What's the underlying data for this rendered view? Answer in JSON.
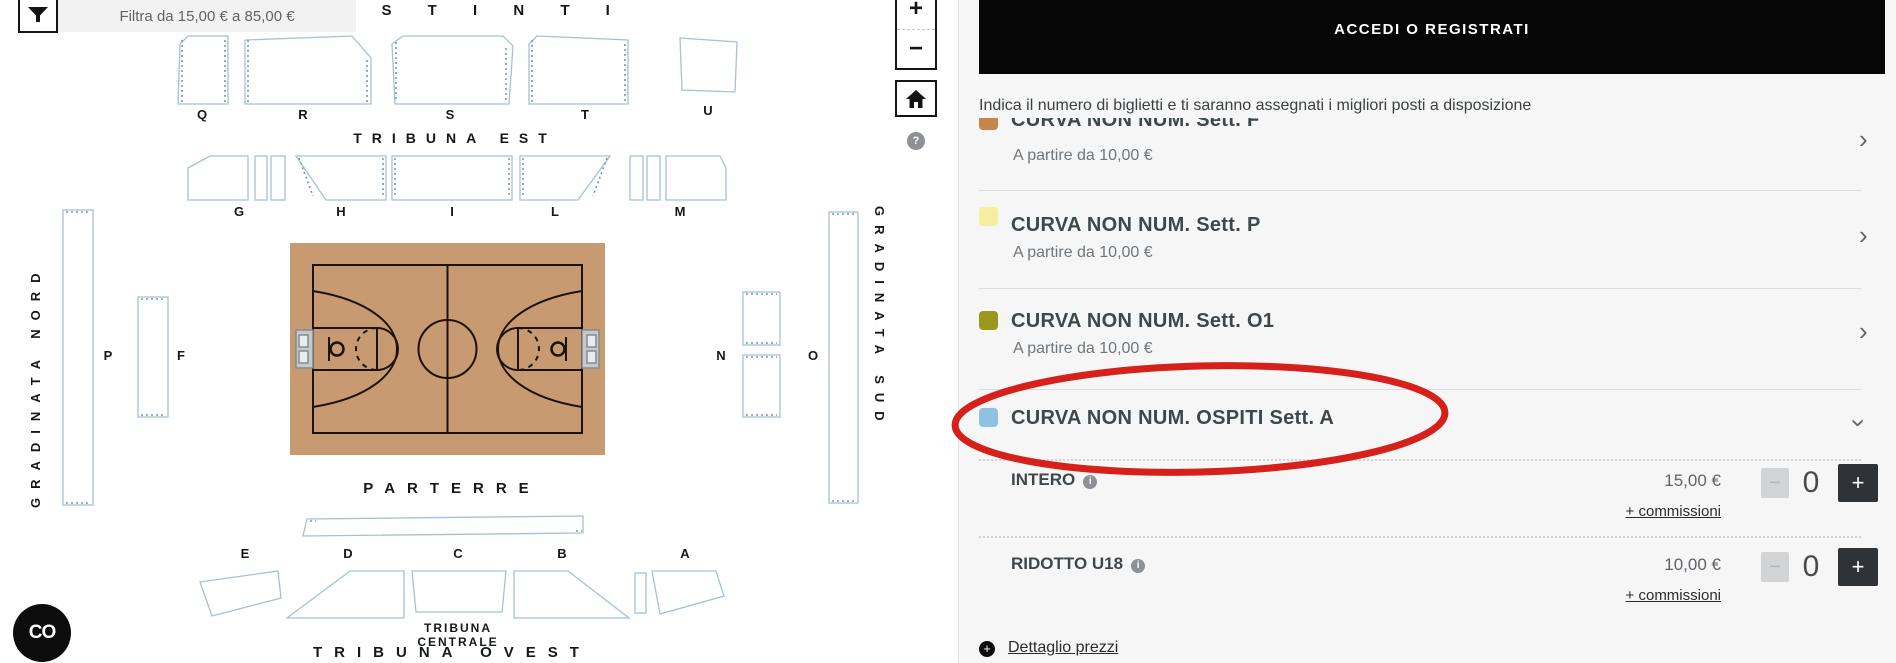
{
  "map": {
    "filter_label": "Filtra da 15,00 € a 85,00 €",
    "zoom_in": "+",
    "zoom_out": "−",
    "help": "?",
    "chat_logo": "CO",
    "labels": {
      "distinti": "D I S T I N T I",
      "tribuna_est": "TRIBUNA EST",
      "parterre": "PARTERRE",
      "tribuna_centrale_1": "TRIBUNA",
      "tribuna_centrale_2": "CENTRALE",
      "tribuna_ovest": "TRIBUNA OVEST",
      "gradinata_nord": "GRADINATA NORD",
      "gradinata_sud": "GRADINATA SUD"
    },
    "sections": {
      "q": "Q",
      "r": "R",
      "s": "S",
      "t": "T",
      "u": "U",
      "g": "G",
      "h": "H",
      "i": "I",
      "l": "L",
      "m": "M",
      "p": "P",
      "f": "F",
      "n": "N",
      "o": "O",
      "e": "E",
      "d": "D",
      "c": "C",
      "b": "B",
      "a": "A"
    },
    "court_color": "#c89a71"
  },
  "panel": {
    "login_button": "ACCEDI O REGISTRATI",
    "instruction": "Indica il numero di biglietti e ti saranno assegnati i migliori posti a disposizione",
    "rows": [
      {
        "title": "CURVA NON NUM. Sett. F",
        "subtitle": "A partire da 10,00 €",
        "swatch": "#c5854c"
      },
      {
        "title": "CURVA NON NUM. Sett. P",
        "subtitle": "A partire da 10,00 €",
        "swatch": "#f6ee9e"
      },
      {
        "title": "CURVA NON NUM. Sett. O1",
        "subtitle": "A partire da 10,00 €",
        "swatch": "#99991f"
      },
      {
        "title": "CURVA NON NUM. OSPITI Sett. A",
        "swatch": "#8fc1e3"
      }
    ],
    "tickets": [
      {
        "label": "INTERO",
        "price": "15,00 €",
        "fees": "+ commissioni",
        "qty": "0"
      },
      {
        "label": "RIDOTTO U18",
        "price": "10,00 €",
        "fees": "+ commissioni",
        "qty": "0"
      }
    ],
    "stepper": {
      "minus": "−",
      "plus": "+"
    },
    "info_icon": "i",
    "price_detail": "Dettaglio prezzi",
    "detail_icon": "+",
    "chevron": "›",
    "highlight_color": "#d6201a"
  }
}
